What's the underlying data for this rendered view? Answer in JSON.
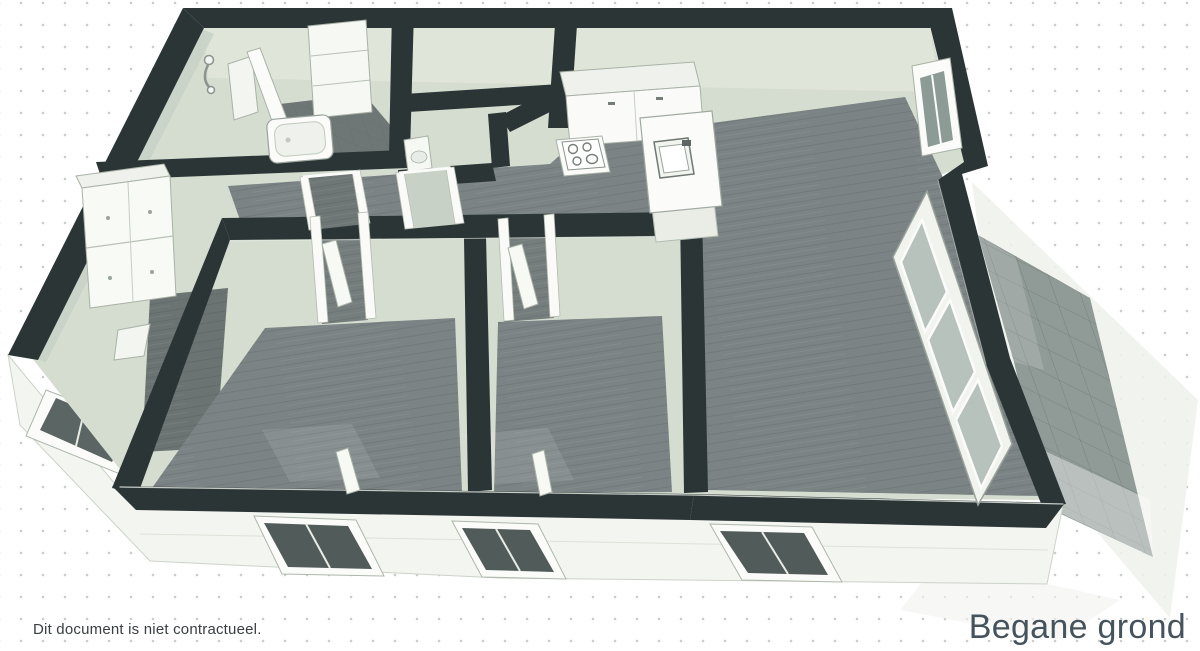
{
  "document": {
    "disclaimer": "Dit document is niet contractueel.",
    "floor_label": "Begane grond"
  },
  "floorplan": {
    "type": "3d-floorplan-render",
    "view": "isometric-cutaway",
    "features": [
      "bathroom-with-bathtub-and-shower",
      "wc-with-toilet",
      "storage-room",
      "kitchen-with-counter-stove-and-island-sink",
      "open-living-room",
      "hallway",
      "entry-hall-with-dresser",
      "bedroom-1",
      "bedroom-2",
      "front-facade-windows",
      "open-glazed-door-to-terrace",
      "tiled-terrace"
    ],
    "colors": {
      "wall_dark": "#2b3536",
      "wall_light": "#d5dcd0",
      "floor_wood": "#7b8384",
      "facade": "#f3f5f1",
      "terrace_tile": "#8f9997",
      "background": "#ffffff",
      "text": "#45535c"
    }
  }
}
